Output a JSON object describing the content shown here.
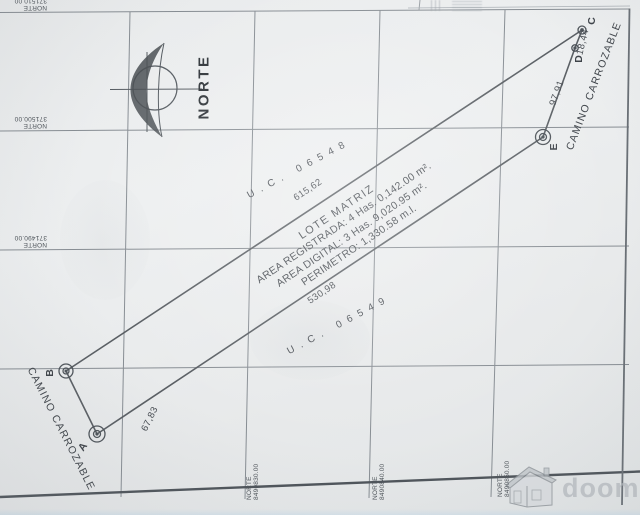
{
  "sheet": {
    "north_label": "NORTE",
    "watermark_text": "doomos"
  },
  "grid": {
    "left_labels": [
      {
        "word": "NORTE",
        "value": "371510.00"
      },
      {
        "word": "NORTE",
        "value": "371500.00"
      },
      {
        "word": "NORTE",
        "value": "371490.00"
      }
    ],
    "bottom_labels": [
      {
        "word": "NORTE",
        "value": "8490830.00"
      },
      {
        "word": "NORTE",
        "value": "8490840.00"
      },
      {
        "word": "NORTE",
        "value": "8490850.00"
      }
    ]
  },
  "parcel": {
    "name": "LOTE MATRIZ",
    "area_registered": "AREA REGISTRADA: 4 Has. 0,142.00 m².",
    "area_digital": "AREA DIGITAL: 3 Has. 9,020.95 m².",
    "perimeter": "PERIMETRO: 1,330.58 m.l.",
    "uc_north": "U.C. 06548",
    "uc_south": "U.C. 06549"
  },
  "vertices": {
    "a": "A",
    "b": "B",
    "c": "C",
    "d": "D",
    "e": "E"
  },
  "distances": {
    "ab": "67,83",
    "bc": "615,62",
    "cd": "18,44",
    "de": "97,91",
    "ea": "530,98"
  },
  "roads": {
    "left": "CAMINO CARROZABLE",
    "right": "CAMINO CARROZABLE"
  }
}
